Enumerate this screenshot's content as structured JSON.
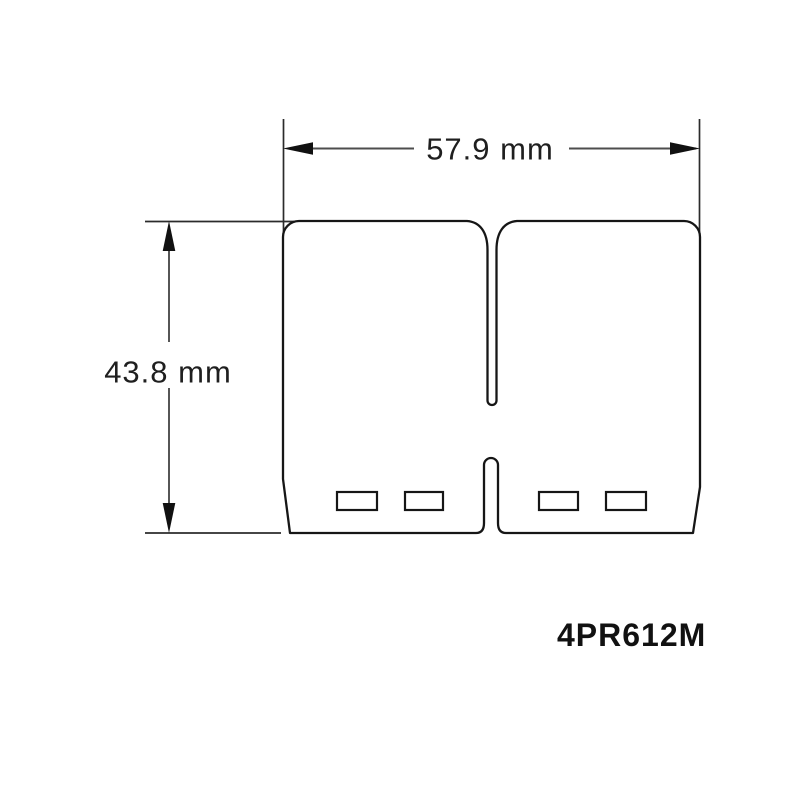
{
  "diagram": {
    "part_number": "4PR612M",
    "width_dimension": {
      "label": "57.9 mm"
    },
    "height_dimension": {
      "label": "43.8 mm"
    }
  },
  "icons": {
    "width_dim_arrow_left": "solid-triangle-arrow-left",
    "width_dim_arrow_right": "solid-triangle-arrow-right",
    "height_dim_arrow_up": "solid-triangle-arrow-up",
    "height_dim_arrow_down": "solid-triangle-arrow-down"
  },
  "colors": {
    "background": "#ffffff",
    "outline": "#161616",
    "dimension_line": "#4d4d4d",
    "extension_line": "#2b2b2b",
    "arrowhead": "#111111",
    "label_text": "#1f1f1f",
    "part_number_text": "#111111"
  }
}
